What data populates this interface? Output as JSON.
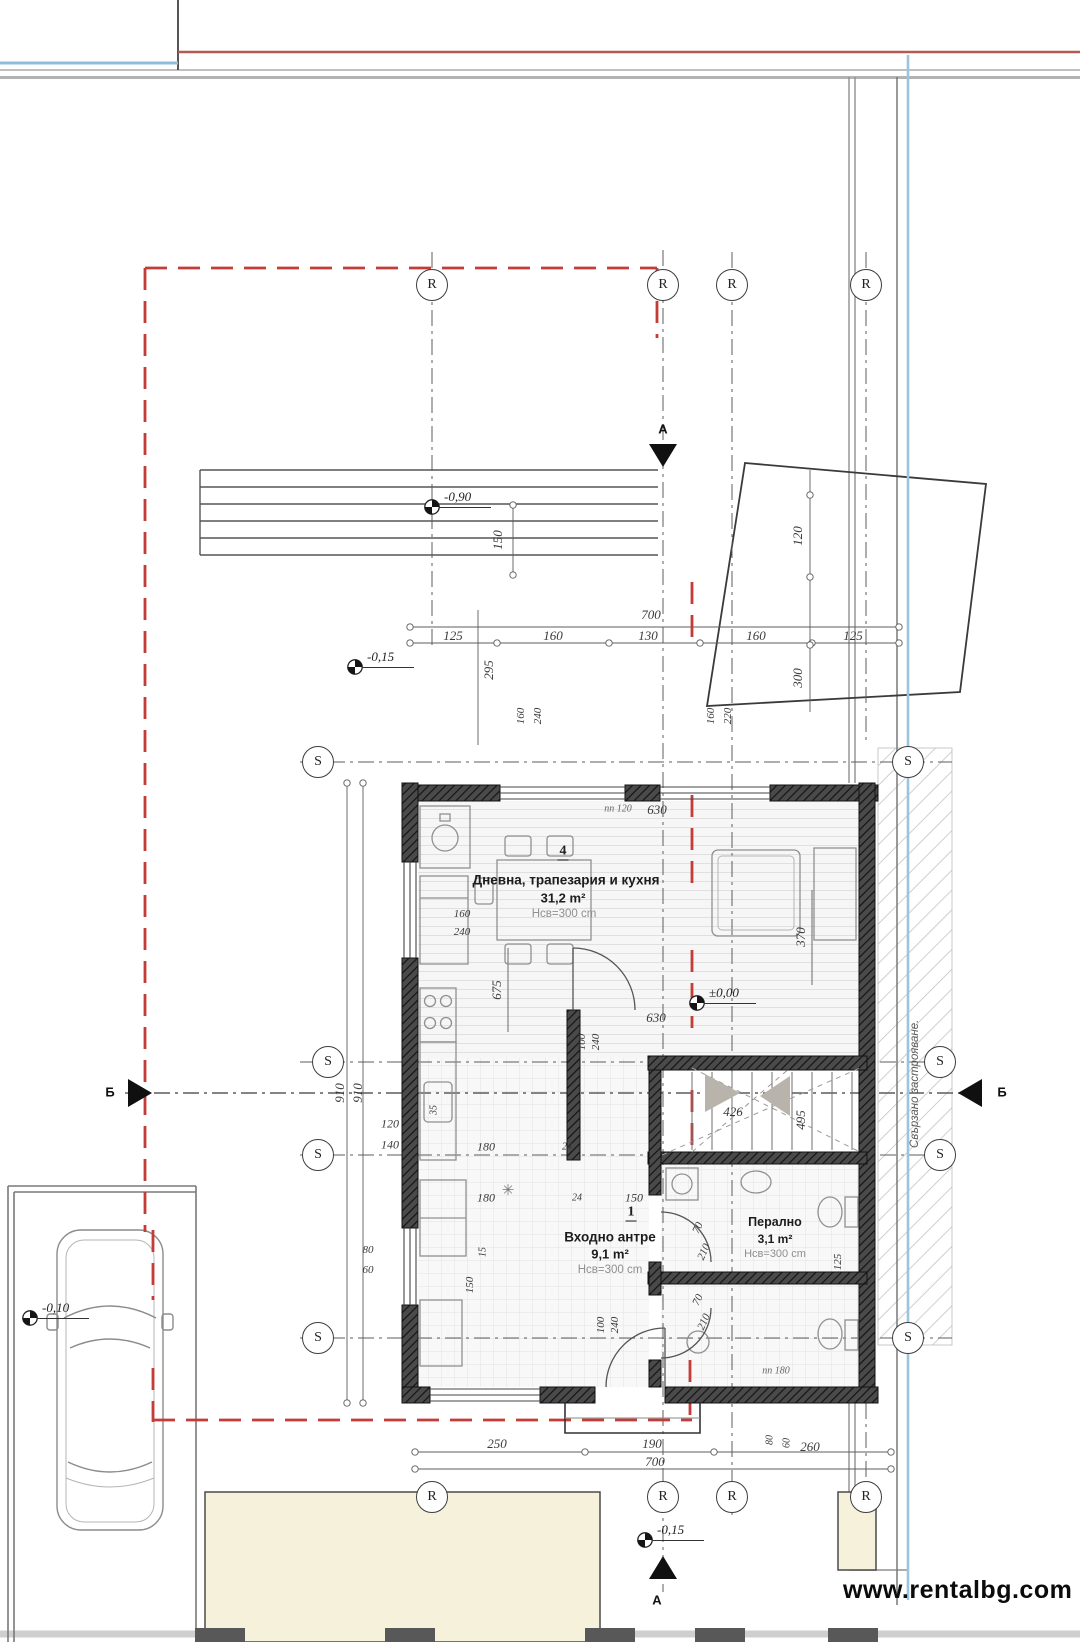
{
  "watermark": {
    "text": "www.rentalbg.com"
  },
  "side_note": {
    "text": "Свързано застрояване."
  },
  "rooms": {
    "living": {
      "number": "4",
      "name": "Дневна, трапезария и кухня",
      "area": "31,2 m²",
      "clear_height": "Нсв=300 cm"
    },
    "hall": {
      "number": "1",
      "name": "Входно антре",
      "area": "9,1 m²",
      "clear_height": "Нсв=300 cm"
    },
    "laundry": {
      "name": "Перално",
      "area": "3,1 m²",
      "clear_height": "Нсв=300 cm"
    }
  },
  "symbols": {
    "floor_drain": "✳"
  },
  "colors": {
    "red_line": "#c43c38",
    "blue_line": "#8fbcd9",
    "boundary_grey": "#999999",
    "wall": "#2e2e2e"
  },
  "grid_markers": [
    {
      "letter": "R",
      "x": 432,
      "y": 285
    },
    {
      "letter": "R",
      "x": 663,
      "y": 285
    },
    {
      "letter": "R",
      "x": 732,
      "y": 285
    },
    {
      "letter": "R",
      "x": 866,
      "y": 285
    },
    {
      "letter": "R",
      "x": 432,
      "y": 1497
    },
    {
      "letter": "R",
      "x": 663,
      "y": 1497
    },
    {
      "letter": "R",
      "x": 732,
      "y": 1497
    },
    {
      "letter": "R",
      "x": 866,
      "y": 1497
    },
    {
      "letter": "S",
      "x": 318,
      "y": 762
    },
    {
      "letter": "S",
      "x": 328,
      "y": 1062
    },
    {
      "letter": "S",
      "x": 318,
      "y": 1155
    },
    {
      "letter": "S",
      "x": 318,
      "y": 1338
    },
    {
      "letter": "S",
      "x": 908,
      "y": 762
    },
    {
      "letter": "S",
      "x": 940,
      "y": 1062
    },
    {
      "letter": "S",
      "x": 940,
      "y": 1155
    },
    {
      "letter": "S",
      "x": 908,
      "y": 1338
    }
  ],
  "section_markers": [
    {
      "label": "А",
      "lx": 663,
      "ly": 429,
      "dir": "down",
      "tx": 649,
      "ty": 444
    },
    {
      "label": "А",
      "lx": 657,
      "ly": 1600,
      "dir": "up",
      "tx": 649,
      "ty": 1556
    },
    {
      "label": "Б",
      "lx": 110,
      "ly": 1092,
      "dir": "right",
      "tx": 128,
      "ty": 1079
    },
    {
      "label": "Б",
      "lx": 1002,
      "ly": 1092,
      "dir": "left",
      "tx": 958,
      "ty": 1079
    }
  ],
  "elevation_markers": [
    {
      "label": "-0,90",
      "x": 432,
      "y": 507
    },
    {
      "label": "-0,15",
      "x": 355,
      "y": 667
    },
    {
      "label": "±0,00",
      "x": 697,
      "y": 1003
    },
    {
      "label": "-0,10",
      "x": 30,
      "y": 1318
    },
    {
      "label": "-0,15",
      "x": 645,
      "y": 1540
    }
  ],
  "dimension_labels": [
    {
      "t": "700",
      "x": 651,
      "y": 615
    },
    {
      "t": "125",
      "x": 453,
      "y": 636
    },
    {
      "t": "160",
      "x": 553,
      "y": 636
    },
    {
      "t": "130",
      "x": 648,
      "y": 636
    },
    {
      "t": "160",
      "x": 756,
      "y": 636
    },
    {
      "t": "125",
      "x": 853,
      "y": 636
    },
    {
      "t": "150",
      "x": 498,
      "y": 540,
      "r": -90
    },
    {
      "t": "295",
      "x": 489,
      "y": 670,
      "r": -90
    },
    {
      "t": "120",
      "x": 798,
      "y": 536,
      "r": -90
    },
    {
      "t": "300",
      "x": 798,
      "y": 678,
      "r": -90
    },
    {
      "t": "160",
      "x": 521,
      "y": 716,
      "r": -90,
      "s": 11
    },
    {
      "t": "240",
      "x": 538,
      "y": 716,
      "r": -90,
      "s": 11
    },
    {
      "t": "160",
      "x": 711,
      "y": 716,
      "r": -90,
      "s": 11
    },
    {
      "t": "220",
      "x": 728,
      "y": 716,
      "r": -90,
      "s": 11
    },
    {
      "t": "630",
      "x": 657,
      "y": 810
    },
    {
      "t": "пп 120",
      "x": 618,
      "y": 809,
      "s": 10,
      "c": "#666"
    },
    {
      "t": "160",
      "x": 462,
      "y": 914,
      "s": 11
    },
    {
      "t": "240",
      "x": 462,
      "y": 932,
      "s": 11
    },
    {
      "t": "370",
      "x": 801,
      "y": 937,
      "r": -90
    },
    {
      "t": "675",
      "x": 497,
      "y": 990,
      "r": -90
    },
    {
      "t": "100",
      "x": 582,
      "y": 1042,
      "r": -90,
      "s": 11
    },
    {
      "t": "240",
      "x": 596,
      "y": 1042,
      "r": -90,
      "s": 11
    },
    {
      "t": "630",
      "x": 656,
      "y": 1018
    },
    {
      "t": "910",
      "x": 340,
      "y": 1093,
      "r": -90
    },
    {
      "t": "910",
      "x": 358,
      "y": 1093,
      "r": -90
    },
    {
      "t": "120",
      "x": 390,
      "y": 1124,
      "s": 12
    },
    {
      "t": "140",
      "x": 390,
      "y": 1145,
      "s": 12
    },
    {
      "t": "35",
      "x": 434,
      "y": 1110,
      "r": -90,
      "s": 10
    },
    {
      "t": "180",
      "x": 486,
      "y": 1147,
      "s": 12
    },
    {
      "t": "24",
      "x": 567,
      "y": 1147,
      "s": 10
    },
    {
      "t": "180",
      "x": 486,
      "y": 1198,
      "s": 12
    },
    {
      "t": "24",
      "x": 577,
      "y": 1198,
      "s": 10
    },
    {
      "t": "150",
      "x": 634,
      "y": 1198,
      "s": 12
    },
    {
      "t": "426",
      "x": 733,
      "y": 1112
    },
    {
      "t": "495",
      "x": 801,
      "y": 1120,
      "r": -90
    },
    {
      "t": "70",
      "x": 698,
      "y": 1228,
      "r": -65,
      "s": 11
    },
    {
      "t": "210",
      "x": 704,
      "y": 1252,
      "r": -65,
      "s": 11
    },
    {
      "t": "70",
      "x": 698,
      "y": 1300,
      "r": -65,
      "s": 11
    },
    {
      "t": "210",
      "x": 704,
      "y": 1322,
      "r": -65,
      "s": 11
    },
    {
      "t": "пп 180",
      "x": 776,
      "y": 1371,
      "s": 10,
      "c": "#666"
    },
    {
      "t": "100",
      "x": 601,
      "y": 1325,
      "r": -90,
      "s": 11
    },
    {
      "t": "240",
      "x": 615,
      "y": 1325,
      "r": -90,
      "s": 11
    },
    {
      "t": "80",
      "x": 368,
      "y": 1250,
      "s": 11
    },
    {
      "t": "60",
      "x": 368,
      "y": 1270,
      "s": 11
    },
    {
      "t": "150",
      "x": 470,
      "y": 1285,
      "r": -90,
      "s": 11
    },
    {
      "t": "15",
      "x": 483,
      "y": 1252,
      "r": -90,
      "s": 10
    },
    {
      "t": "125",
      "x": 838,
      "y": 1262,
      "r": -90,
      "s": 11
    },
    {
      "t": "250",
      "x": 497,
      "y": 1444
    },
    {
      "t": "190",
      "x": 652,
      "y": 1444
    },
    {
      "t": "260",
      "x": 810,
      "y": 1447
    },
    {
      "t": "700",
      "x": 655,
      "y": 1462
    },
    {
      "t": "80",
      "x": 770,
      "y": 1440,
      "r": -90,
      "s": 10
    },
    {
      "t": "60",
      "x": 787,
      "y": 1443,
      "r": -90,
      "s": 10
    }
  ]
}
